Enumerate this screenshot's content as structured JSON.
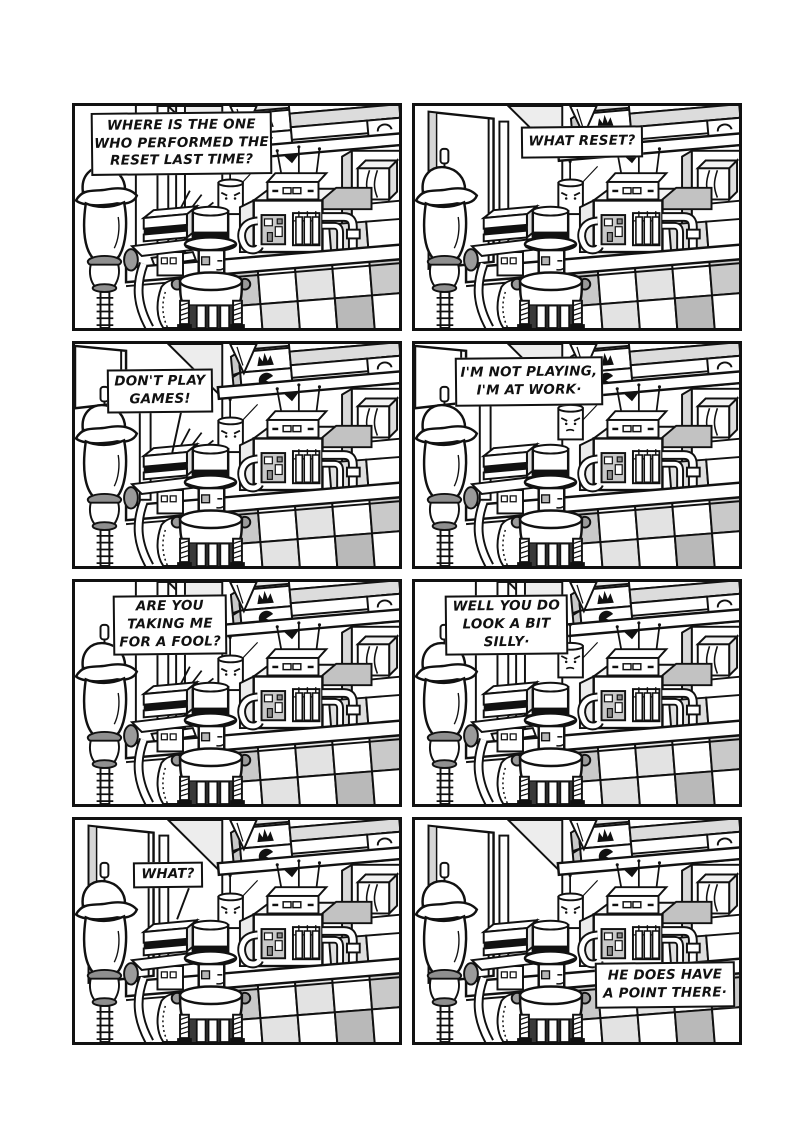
{
  "page": {
    "background": "#ffffff",
    "ink": "#111111",
    "paper": "#ffffff"
  },
  "comic": {
    "panels": [
      {
        "name": "panel-1",
        "speech": {
          "lines": [
            "WHERE IS THE ONE",
            "WHO PERFORMED THE",
            "RESET LAST TIME?"
          ],
          "left": 16,
          "top": 6,
          "width": 181,
          "height": 63
        },
        "scene": {
          "left_wall": "window",
          "light_rays": true,
          "candle_raised": false,
          "tail": null
        }
      },
      {
        "name": "panel-2",
        "speech": {
          "lines": [
            "WHAT RESET?"
          ],
          "left": 106,
          "top": 20,
          "width": 122,
          "height": 32
        },
        "scene": {
          "left_wall": "door",
          "light_rays": false,
          "candle_raised": false,
          "tail": null
        }
      },
      {
        "name": "panel-3",
        "speech": {
          "lines": [
            "DON'T PLAY",
            "GAMES!"
          ],
          "left": 32,
          "top": 25,
          "width": 106,
          "height": 44
        },
        "scene": {
          "left_wall": "door-corner",
          "light_rays": true,
          "candle_raised": false,
          "tail": [
            108,
            70,
            99,
            112
          ]
        }
      },
      {
        "name": "panel-4",
        "speech": {
          "lines": [
            "I'M NOT PLAYING,",
            "I'M AT WORK·"
          ],
          "left": 40,
          "top": 13,
          "width": 148,
          "height": 49
        },
        "scene": {
          "left_wall": "door-corner",
          "light_rays": false,
          "candle_raised": true,
          "tail": null
        }
      },
      {
        "name": "panel-5",
        "speech": {
          "lines": [
            "ARE YOU",
            "TAKING ME",
            "FOR A FOOL?"
          ],
          "left": 38,
          "top": 13,
          "width": 114,
          "height": 60
        },
        "scene": {
          "left_wall": "window",
          "light_rays": true,
          "candle_raised": false,
          "tail": null
        }
      },
      {
        "name": "panel-6",
        "speech": {
          "lines": [
            "WELL YOU DO",
            "LOOK A BIT",
            "SILLY·"
          ],
          "left": 30,
          "top": 13,
          "width": 123,
          "height": 60
        },
        "scene": {
          "left_wall": "window",
          "light_rays": false,
          "candle_raised": true,
          "tail": null
        }
      },
      {
        "name": "panel-7",
        "speech": {
          "lines": [
            "WHAT?"
          ],
          "left": 58,
          "top": 42,
          "width": 70,
          "height": 26
        },
        "scene": {
          "left_wall": "door",
          "light_rays": false,
          "candle_raised": false,
          "tail": [
            116,
            70,
            104,
            102
          ]
        }
      },
      {
        "name": "panel-8",
        "speech": {
          "lines": [
            "HE DOES HAVE",
            "A POINT THERE·"
          ],
          "left": 180,
          "top": 142,
          "width": 140,
          "height": 46
        },
        "scene": {
          "left_wall": "door",
          "light_rays": false,
          "candle_raised": false,
          "tail": null
        }
      }
    ]
  }
}
